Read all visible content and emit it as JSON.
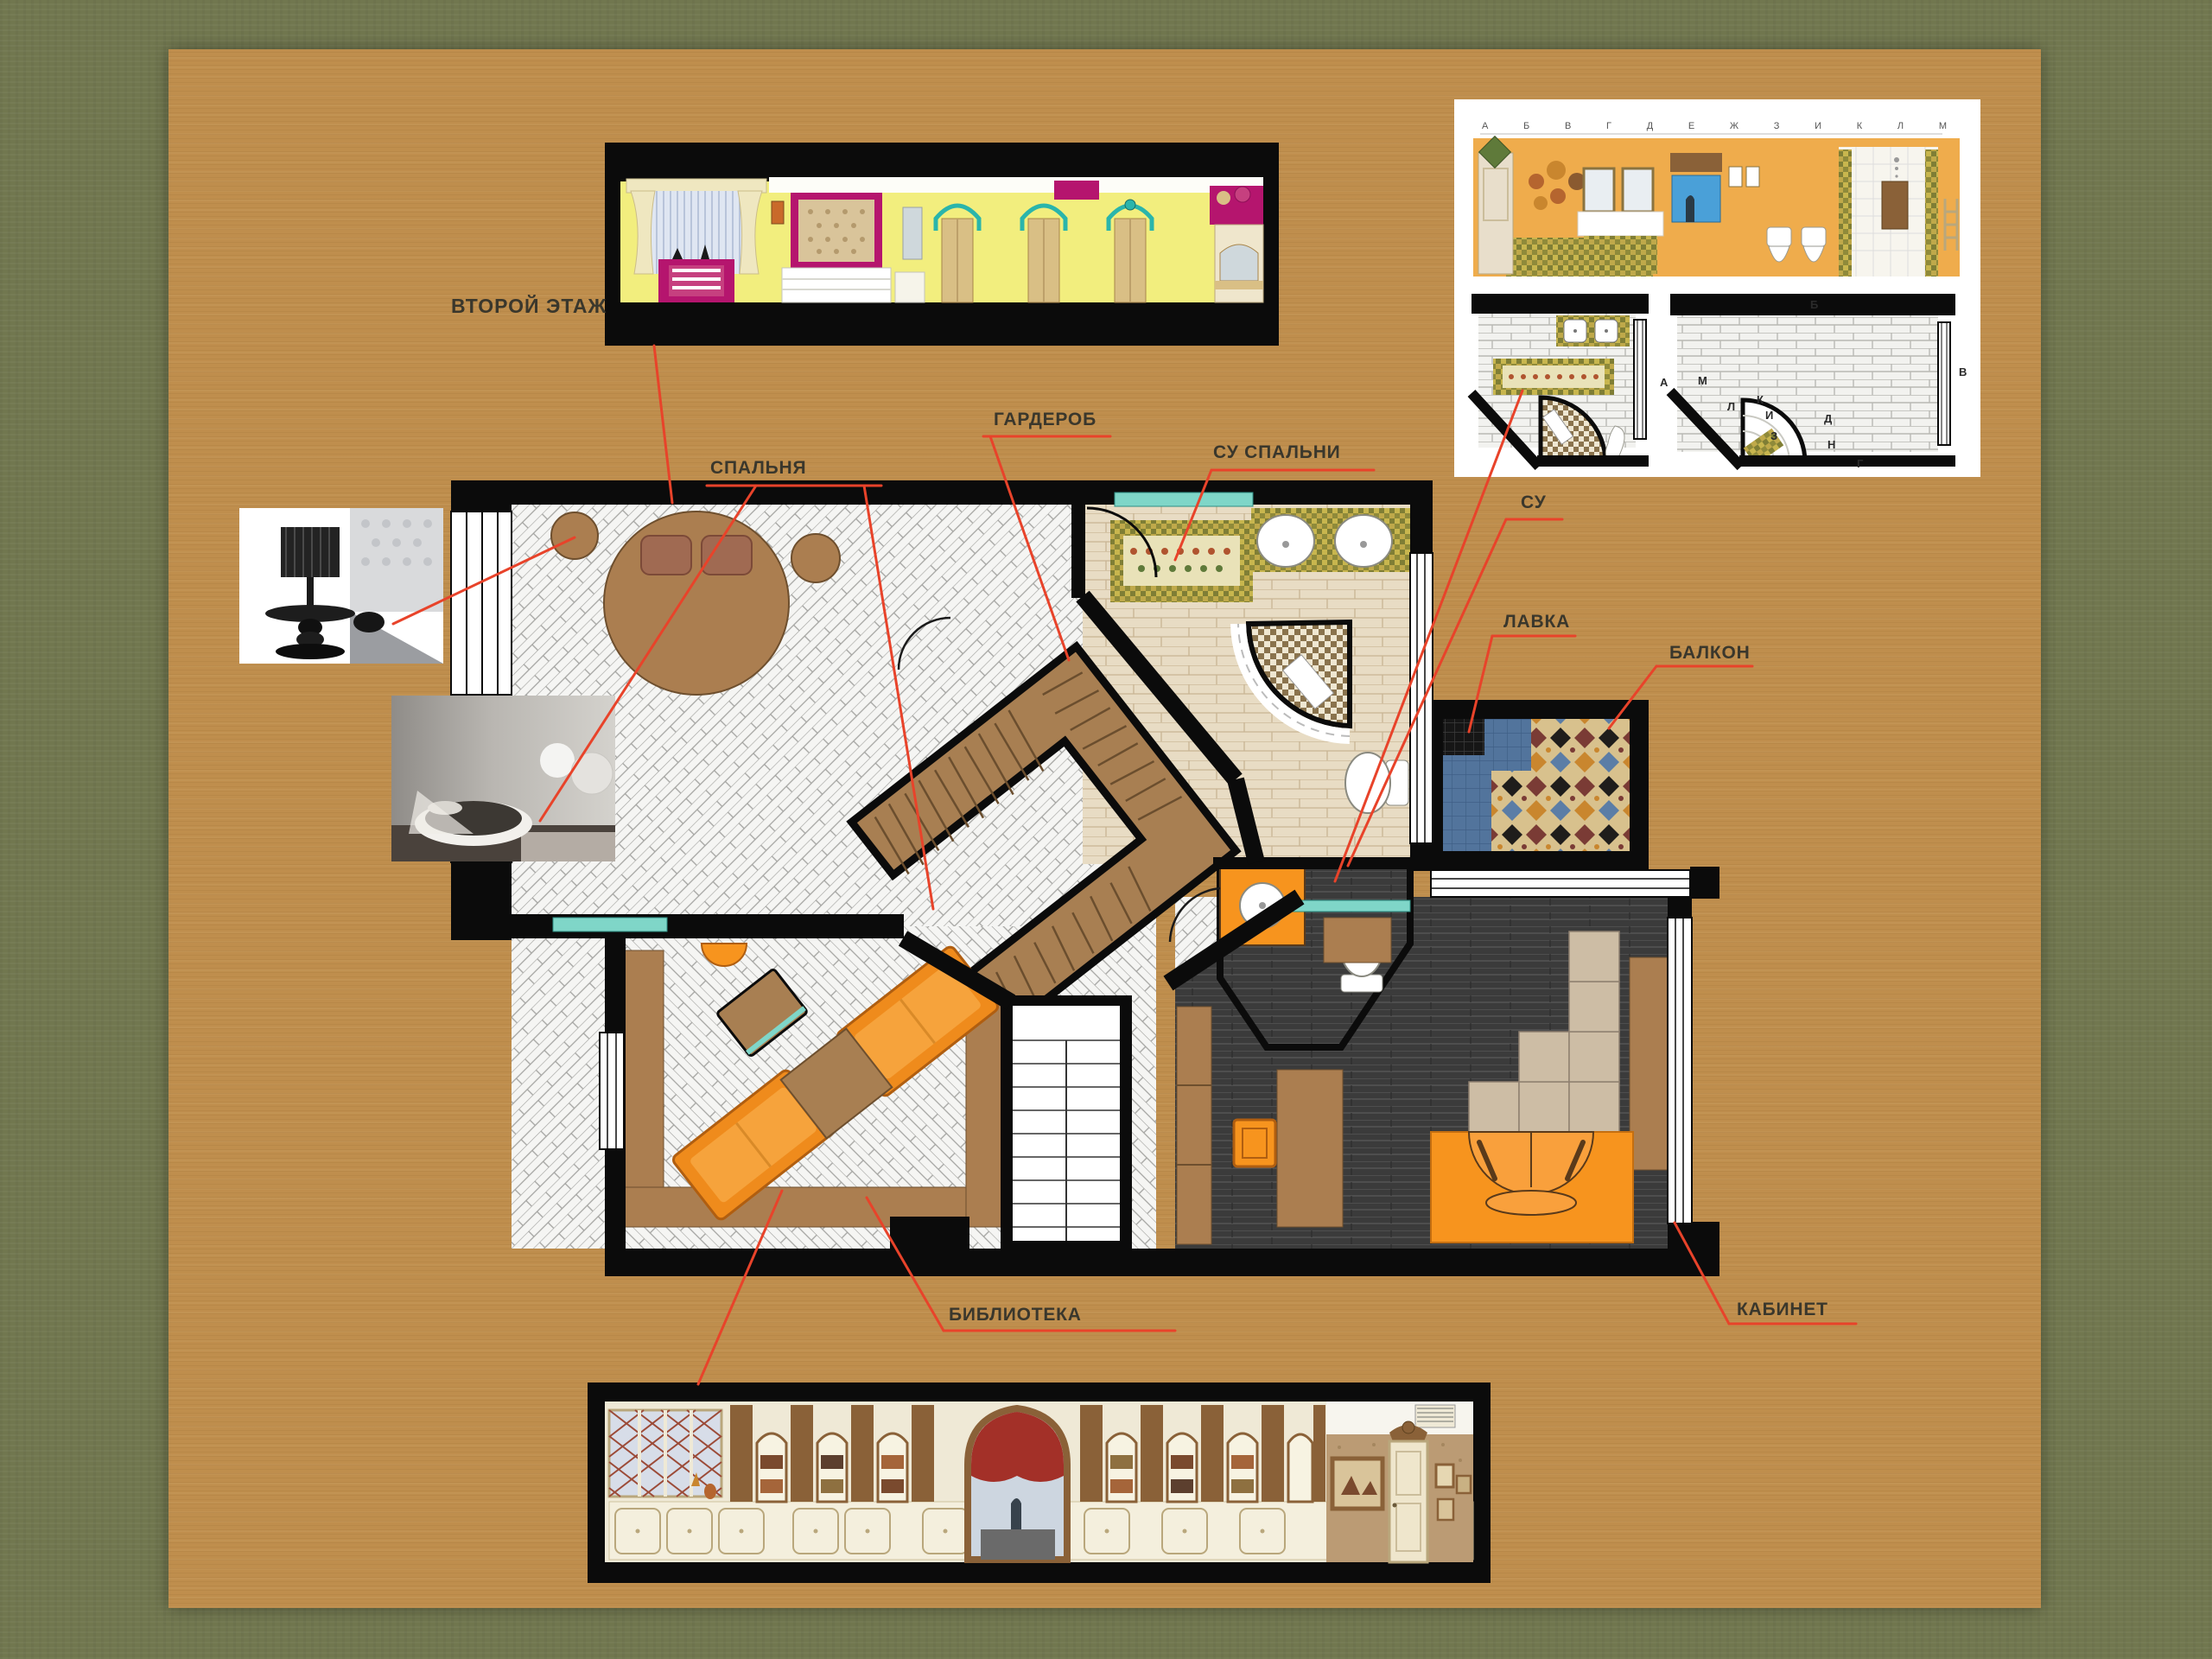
{
  "page": {
    "floor_title": "ВТОРОЙ ЭТАЖ"
  },
  "callouts": {
    "bedroom": "СПАЛЬНЯ",
    "wardrobe": "ГАРДЕРОБ",
    "bedroom_bathroom": "СУ СПАЛЬНИ",
    "bathroom": "СУ",
    "bench": "ЛАВКА",
    "balcony": "БАЛКОН",
    "library": "БИБЛИОТЕКА",
    "study": "КАБИНЕТ"
  },
  "details_panel": {
    "ruler_letters": "А Б В Г Д Е Ж З И К Л М",
    "plan_b_markers": [
      "Б",
      "А",
      "В",
      "Г",
      "М",
      "Л",
      "К",
      "И",
      "З",
      "Д",
      "Н"
    ]
  },
  "colors": {
    "background": "#71774f",
    "board": "#bf8e4d",
    "frame_black": "#0b0b0b",
    "leader_red": "#e8432a",
    "label_text": "#3a372c",
    "accent_orange": "#f7941e",
    "wood_brown": "#a87f52",
    "dark_floor": "#3a3a3a",
    "teal": "#7fd6c8",
    "magenta": "#b5156e",
    "elevation_yellow": "#f2ee7e",
    "panel_wall_orange": "#efac4c"
  }
}
